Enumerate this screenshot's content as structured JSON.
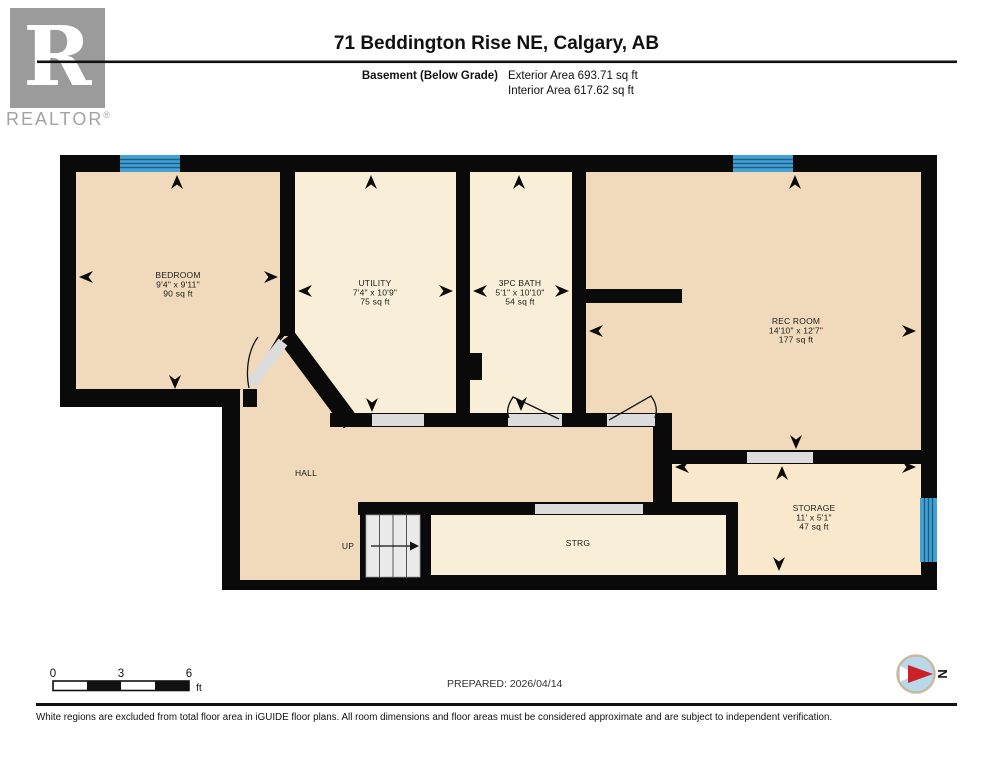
{
  "header": {
    "title": "71 Beddington Rise NE, Calgary, AB",
    "floor_label": "Basement (Below Grade)",
    "exterior_area": "Exterior Area 693.71 sq ft",
    "interior_area": "Interior Area 617.62 sq ft"
  },
  "logo": {
    "letter": "R",
    "wordmark": "REALTOR",
    "registered": "®"
  },
  "rooms": [
    {
      "name": "BEDROOM",
      "dims": "9'4\" x 9'11\"",
      "area": "90 sq ft"
    },
    {
      "name": "UTILITY",
      "dims": "7'4\" x 10'9\"",
      "area": "75 sq ft"
    },
    {
      "name": "3PC BATH",
      "dims": "5'1\" x 10'10\"",
      "area": "54 sq ft"
    },
    {
      "name": "REC ROOM",
      "dims": "14'10\" x 12'7\"",
      "area": "177 sq ft"
    },
    {
      "name": "STORAGE",
      "dims": "11' x 5'1\"",
      "area": "47 sq ft"
    }
  ],
  "plan_labels": {
    "hall": "HALL",
    "up": "UP",
    "strg": "STRG"
  },
  "scale_bar": {
    "tick0": "0",
    "tick3": "3",
    "tick6": "6",
    "unit": "ft"
  },
  "prepared": "PREPARED: 2026/04/14",
  "compass": {
    "north": "N"
  },
  "footer": {
    "disclaimer": "White regions are excluded from total floor area in iGUIDE floor plans. All room dimensions and floor areas must be considered approximate and are subject to independent verification."
  },
  "colors": {
    "wall": "#0a0a0a",
    "floor_tan": "#f0dabb",
    "floor_cream": "#f9efd8",
    "floor_storage": "#f9e8cc",
    "window_blue": "#45a1d2",
    "window_line": "#1b5e87",
    "door_gray": "#dcdcdc",
    "stair_gray": "#eaeaea",
    "compass_red": "#cc2027",
    "compass_blue": "#b9d8e9",
    "logo_gray": "#9b9b9b"
  }
}
